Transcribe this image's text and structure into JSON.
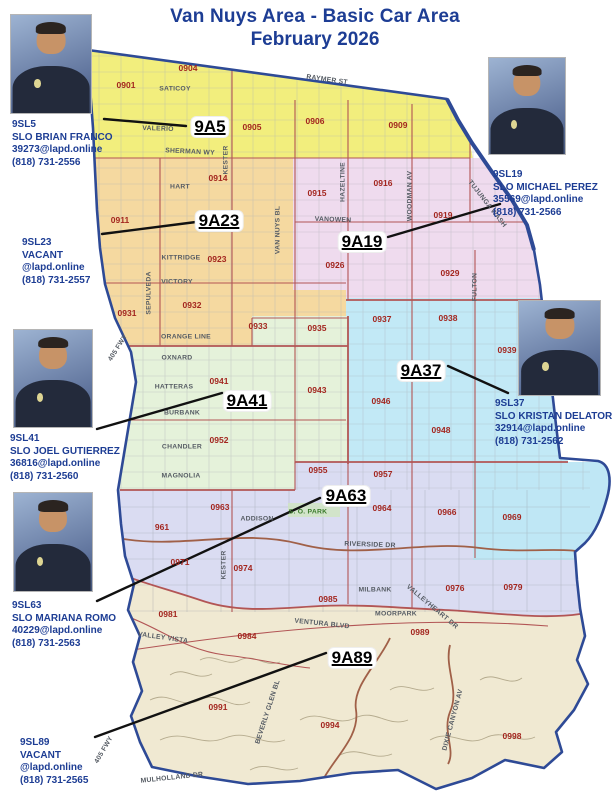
{
  "title": {
    "line1": "Van Nuys Area - Basic Car Area",
    "line2": "February 2026"
  },
  "colors": {
    "title": "#1d3d94",
    "officer_text": "#1d3d94",
    "district_text": "#a3261f",
    "street_text": "#565c64",
    "park_text": "#3a7a2a",
    "boundary": "#2e4a96",
    "district_line": "#b25555",
    "road_line": "#a06048",
    "callout": "#111111",
    "zones": {
      "z9A5": "#f2ee7d",
      "z9A23": "#f5d9a0",
      "z9A19": "#efdbee",
      "z9A37": "#c2e9f6",
      "z9A41": "#e5f2da",
      "z9A63": "#dadcf2",
      "z969": "#bfe7f5",
      "z9A89": "#f0e9d2"
    }
  },
  "officers": [
    {
      "id": "9SL5",
      "name": "SLO BRIAN FRANCO",
      "email": "39273@lapd.online",
      "phone": "(818) 731-2556",
      "has_photo": true,
      "photo": {
        "x": 10,
        "y": 14,
        "w": 82,
        "h": 100
      },
      "text": {
        "x": 12,
        "y": 119
      }
    },
    {
      "id": "9SL19",
      "name": "SLO MICHAEL PEREZ",
      "email": "35569@lapd.online",
      "phone": "(818) 731-2566",
      "has_photo": true,
      "photo": {
        "x": 488,
        "y": 57,
        "w": 78,
        "h": 98
      },
      "text": {
        "x": 493,
        "y": 169
      }
    },
    {
      "id": "9SL23",
      "name": "VACANT",
      "email": "@lapd.online",
      "phone": "(818) 731-2557",
      "has_photo": false,
      "photo": null,
      "text": {
        "x": 22,
        "y": 237
      }
    },
    {
      "id": "9SL41",
      "name": "SLO JOEL GUTIERREZ",
      "email": "36816@lapd.online",
      "phone": "(818) 731-2560",
      "has_photo": true,
      "photo": {
        "x": 13,
        "y": 329,
        "w": 80,
        "h": 99
      },
      "text": {
        "x": 10,
        "y": 433
      }
    },
    {
      "id": "9SL37",
      "name": "SLO KRISTAN DELATORI",
      "email": "32914@lapd.online",
      "phone": "(818) 731-2562",
      "has_photo": true,
      "photo": {
        "x": 518,
        "y": 300,
        "w": 83,
        "h": 96
      },
      "text": {
        "x": 495,
        "y": 398
      }
    },
    {
      "id": "9SL63",
      "name": "SLO MARIANA ROMO",
      "email": "40229@lapd.online",
      "phone": "(818) 731-2563",
      "has_photo": true,
      "photo": {
        "x": 13,
        "y": 492,
        "w": 80,
        "h": 100
      },
      "text": {
        "x": 12,
        "y": 600
      }
    },
    {
      "id": "9SL89",
      "name": "VACANT",
      "email": "@lapd.online",
      "phone": "(818) 731-2565",
      "has_photo": false,
      "photo": null,
      "text": {
        "x": 20,
        "y": 737
      }
    }
  ],
  "area_labels": [
    {
      "label": "9A5",
      "x": 210,
      "y": 127
    },
    {
      "label": "9A23",
      "x": 219,
      "y": 221
    },
    {
      "label": "9A19",
      "x": 362,
      "y": 242
    },
    {
      "label": "9A37",
      "x": 421,
      "y": 371
    },
    {
      "label": "9A41",
      "x": 247,
      "y": 401
    },
    {
      "label": "9A63",
      "x": 346,
      "y": 496
    },
    {
      "label": "9A89",
      "x": 352,
      "y": 658
    }
  ],
  "districts": [
    {
      "label": "0901",
      "x": 126,
      "y": 85
    },
    {
      "label": "0904",
      "x": 188,
      "y": 68
    },
    {
      "label": "0905",
      "x": 252,
      "y": 127
    },
    {
      "label": "0906",
      "x": 315,
      "y": 121
    },
    {
      "label": "0909",
      "x": 398,
      "y": 125
    },
    {
      "label": "0911",
      "x": 120,
      "y": 220
    },
    {
      "label": "0914",
      "x": 218,
      "y": 178
    },
    {
      "label": "0915",
      "x": 317,
      "y": 193
    },
    {
      "label": "0916",
      "x": 383,
      "y": 183
    },
    {
      "label": "0919",
      "x": 443,
      "y": 215
    },
    {
      "label": "0923",
      "x": 217,
      "y": 259
    },
    {
      "label": "0926",
      "x": 335,
      "y": 265
    },
    {
      "label": "0929",
      "x": 450,
      "y": 273
    },
    {
      "label": "0931",
      "x": 127,
      "y": 313
    },
    {
      "label": "0932",
      "x": 192,
      "y": 305
    },
    {
      "label": "0933",
      "x": 258,
      "y": 326
    },
    {
      "label": "0935",
      "x": 317,
      "y": 328
    },
    {
      "label": "0937",
      "x": 382,
      "y": 319
    },
    {
      "label": "0938",
      "x": 448,
      "y": 318
    },
    {
      "label": "0939",
      "x": 507,
      "y": 350
    },
    {
      "label": "0941",
      "x": 219,
      "y": 381
    },
    {
      "label": "0943",
      "x": 317,
      "y": 390
    },
    {
      "label": "0946",
      "x": 381,
      "y": 401
    },
    {
      "label": "0948",
      "x": 441,
      "y": 430
    },
    {
      "label": "0952",
      "x": 219,
      "y": 440
    },
    {
      "label": "0955",
      "x": 318,
      "y": 470
    },
    {
      "label": "0957",
      "x": 383,
      "y": 474
    },
    {
      "label": "961",
      "x": 162,
      "y": 527
    },
    {
      "label": "0963",
      "x": 220,
      "y": 507
    },
    {
      "label": "0964",
      "x": 382,
      "y": 508
    },
    {
      "label": "0966",
      "x": 447,
      "y": 512
    },
    {
      "label": "0969",
      "x": 512,
      "y": 517
    },
    {
      "label": "0971",
      "x": 180,
      "y": 562
    },
    {
      "label": "0974",
      "x": 243,
      "y": 568
    },
    {
      "label": "0976",
      "x": 455,
      "y": 588
    },
    {
      "label": "0979",
      "x": 513,
      "y": 587
    },
    {
      "label": "0981",
      "x": 168,
      "y": 614
    },
    {
      "label": "0984",
      "x": 247,
      "y": 636
    },
    {
      "label": "0985",
      "x": 328,
      "y": 599
    },
    {
      "label": "0989",
      "x": 420,
      "y": 632
    },
    {
      "label": "0991",
      "x": 218,
      "y": 707
    },
    {
      "label": "0994",
      "x": 330,
      "y": 725
    },
    {
      "label": "0998",
      "x": 512,
      "y": 736
    }
  ],
  "streets": [
    {
      "label": "RAYMER ST",
      "x": 327,
      "y": 80,
      "rot": 8
    },
    {
      "label": "SATICOY",
      "x": 175,
      "y": 89,
      "rot": 0
    },
    {
      "label": "VALERIO",
      "x": 158,
      "y": 129,
      "rot": 2
    },
    {
      "label": "SHERMAN WY",
      "x": 190,
      "y": 152,
      "rot": 3
    },
    {
      "label": "KESTER",
      "x": 226,
      "y": 160,
      "rot": -90
    },
    {
      "label": "HART",
      "x": 180,
      "y": 187,
      "rot": 0
    },
    {
      "label": "VAN NUYS BL",
      "x": 278,
      "y": 230,
      "rot": -90
    },
    {
      "label": "HAZELTINE",
      "x": 343,
      "y": 182,
      "rot": -90
    },
    {
      "label": "VANOWEN",
      "x": 333,
      "y": 220,
      "rot": 2
    },
    {
      "label": "WOODMAN AV",
      "x": 410,
      "y": 196,
      "rot": -90
    },
    {
      "label": "TUJUNGA WASH",
      "x": 487,
      "y": 204,
      "rot": 52
    },
    {
      "label": "KITTRIDGE",
      "x": 181,
      "y": 258,
      "rot": 0
    },
    {
      "label": "VICTORY",
      "x": 177,
      "y": 282,
      "rot": 0
    },
    {
      "label": "SEPULVEDA",
      "x": 149,
      "y": 293,
      "rot": -90
    },
    {
      "label": "ORANGE LINE",
      "x": 186,
      "y": 337,
      "rot": 0
    },
    {
      "label": "OXNARD",
      "x": 177,
      "y": 358,
      "rot": 0
    },
    {
      "label": "HATTERAS",
      "x": 174,
      "y": 387,
      "rot": 0
    },
    {
      "label": "BURBANK",
      "x": 182,
      "y": 413,
      "rot": 0
    },
    {
      "label": "FULTON",
      "x": 475,
      "y": 287,
      "rot": -90
    },
    {
      "label": "CHANDLER",
      "x": 182,
      "y": 447,
      "rot": 0
    },
    {
      "label": "MAGNOLIA",
      "x": 181,
      "y": 476,
      "rot": 0
    },
    {
      "label": "ADDISON",
      "x": 257,
      "y": 519,
      "rot": 0
    },
    {
      "label": "S. O. PARK",
      "x": 308,
      "y": 512,
      "rot": 0,
      "park": true
    },
    {
      "label": "RIVERSIDE DR",
      "x": 370,
      "y": 545,
      "rot": 2
    },
    {
      "label": "KESTER",
      "x": 224,
      "y": 565,
      "rot": -90
    },
    {
      "label": "MILBANK",
      "x": 375,
      "y": 590,
      "rot": 0
    },
    {
      "label": "VALLEYHEART DR",
      "x": 432,
      "y": 607,
      "rot": 40
    },
    {
      "label": "VENTURA BLVD",
      "x": 322,
      "y": 624,
      "rot": 6
    },
    {
      "label": "MOORPARK",
      "x": 396,
      "y": 614,
      "rot": 0
    },
    {
      "label": "VALLEY VISTA",
      "x": 163,
      "y": 638,
      "rot": 8
    },
    {
      "label": "BEVERLY GLEN BL",
      "x": 268,
      "y": 712,
      "rot": -72
    },
    {
      "label": "DIXIE CANYON AV",
      "x": 453,
      "y": 720,
      "rot": -75
    },
    {
      "label": "MULHOLLAND DR",
      "x": 172,
      "y": 778,
      "rot": -6
    },
    {
      "label": "405 FWY",
      "x": 118,
      "y": 348,
      "rot": -58
    },
    {
      "label": "405 FWY",
      "x": 104,
      "y": 750,
      "rot": -60
    }
  ]
}
